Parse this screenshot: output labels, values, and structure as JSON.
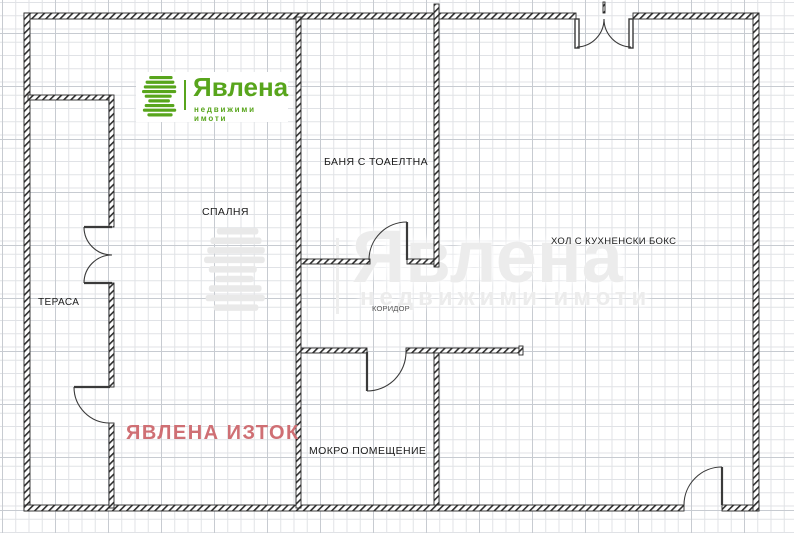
{
  "plan": {
    "rooms": [
      {
        "id": "terrace",
        "label": "ТЕРАСА"
      },
      {
        "id": "bedroom",
        "label": "СПАЛНЯ"
      },
      {
        "id": "bathroom",
        "label": "БАНЯ С ТОАЕЛТНА"
      },
      {
        "id": "living",
        "label": "ХОЛ С КУХНЕНСКИ БОКС"
      },
      {
        "id": "corridor",
        "label": "КОРИДОР"
      },
      {
        "id": "wet_room",
        "label": "МОКРО ПОМЕЩЕНИЕ"
      }
    ],
    "stamp": {
      "text": "ЯВЛЕНА ИЗТОК",
      "color": "#cf6f74"
    }
  },
  "brand": {
    "logo": {
      "name": "Явлена",
      "tagline": "недвижими имоти",
      "color": "#58a51c",
      "icon": "yavlena-stripes-logo"
    },
    "watermark": {
      "name": "Явлена",
      "tagline": "недвижими имоти",
      "color": "#ececec",
      "icon": "yavlena-stripes-logo"
    }
  }
}
